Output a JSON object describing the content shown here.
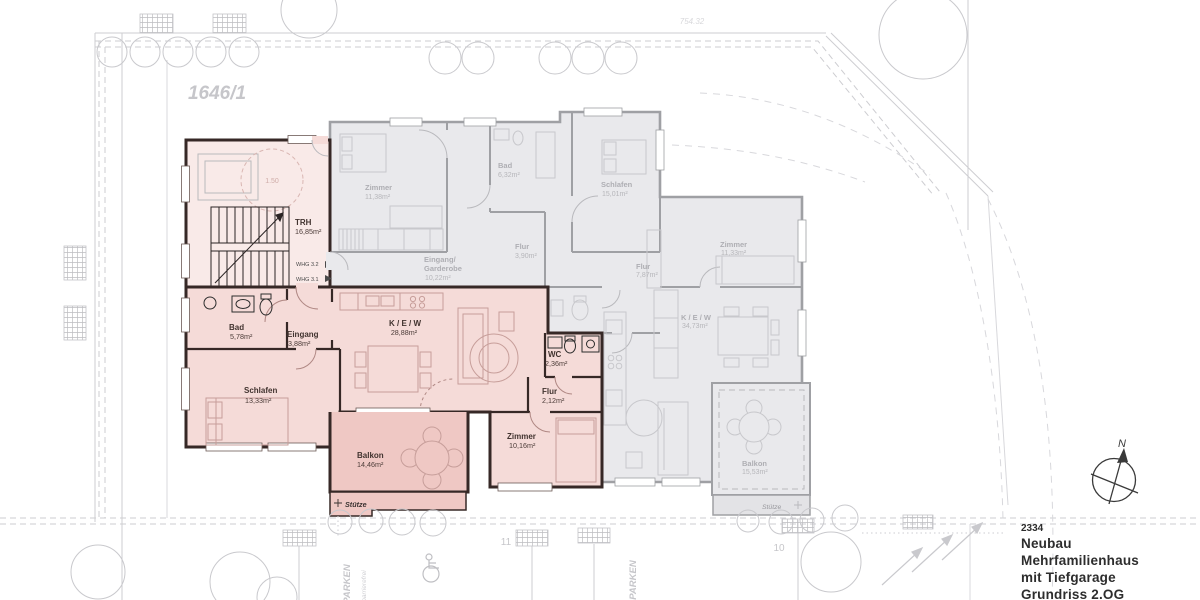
{
  "title_block": {
    "project_number": "2334",
    "title_lines": [
      "Neubau",
      "Mehrfamilienhaus",
      "mit Tiefgarage",
      "Grundriss 2.OG"
    ]
  },
  "compass": {
    "label": "N"
  },
  "site": {
    "plot_number": "1646/1",
    "elevation_note": "754.32",
    "parking_label_left": "PARKEN",
    "parking_label_right": "PARKEN",
    "accessible_label": "barrierefrei",
    "stall_number_11": "11",
    "stall_number_10": "10"
  },
  "stairwell": {
    "room": {
      "name": "TRH",
      "area": "16,85m²"
    },
    "turning_circle": "1.50",
    "door_labels": {
      "whg32": "WHG 3.2",
      "whg31": "WHG 3.1"
    }
  },
  "apartment_pink": {
    "rooms": [
      {
        "name": "Bad",
        "area": "5,78m²"
      },
      {
        "name": "Eingang",
        "area": "3,88m²"
      },
      {
        "name": "Schlafen",
        "area": "13,33m²"
      },
      {
        "name": "K / E / W",
        "area": "28,88m²"
      },
      {
        "name": "WC",
        "area": "2,36m²"
      },
      {
        "name": "Flur",
        "area": "2,12m²"
      },
      {
        "name": "Zimmer",
        "area": "10,16m²"
      },
      {
        "name": "Balkon",
        "area": "14,46m²"
      }
    ],
    "support_label": "Stütze"
  },
  "apartment_gray_top": {
    "rooms": [
      {
        "name": "Zimmer",
        "area": "11,38m²"
      },
      {
        "name": "Bad",
        "area": "6,32m²"
      },
      {
        "name": "Schlafen",
        "area": "15,01m²"
      },
      {
        "name": "Eingang/",
        "name2": "Garderobe",
        "area": "10,22m²"
      },
      {
        "name": "Flur",
        "area": "3,90m²"
      }
    ]
  },
  "apartment_gray_right": {
    "rooms": [
      {
        "name": "Zimmer",
        "area": "11,33m²"
      },
      {
        "name": "Flur",
        "area": "7,87m²"
      },
      {
        "name": "K / E / W",
        "area": "34,73m²"
      },
      {
        "name": "Balkon",
        "area": "15,53m²"
      }
    ],
    "support_label": "Stütze"
  },
  "colors": {
    "highlight_fill": "#f5dbd8",
    "highlight_wall": "#362826",
    "gray_fill": "#e9e9ec",
    "gray_wall": "#9fa0a4",
    "site_line": "#cdcdd1"
  }
}
